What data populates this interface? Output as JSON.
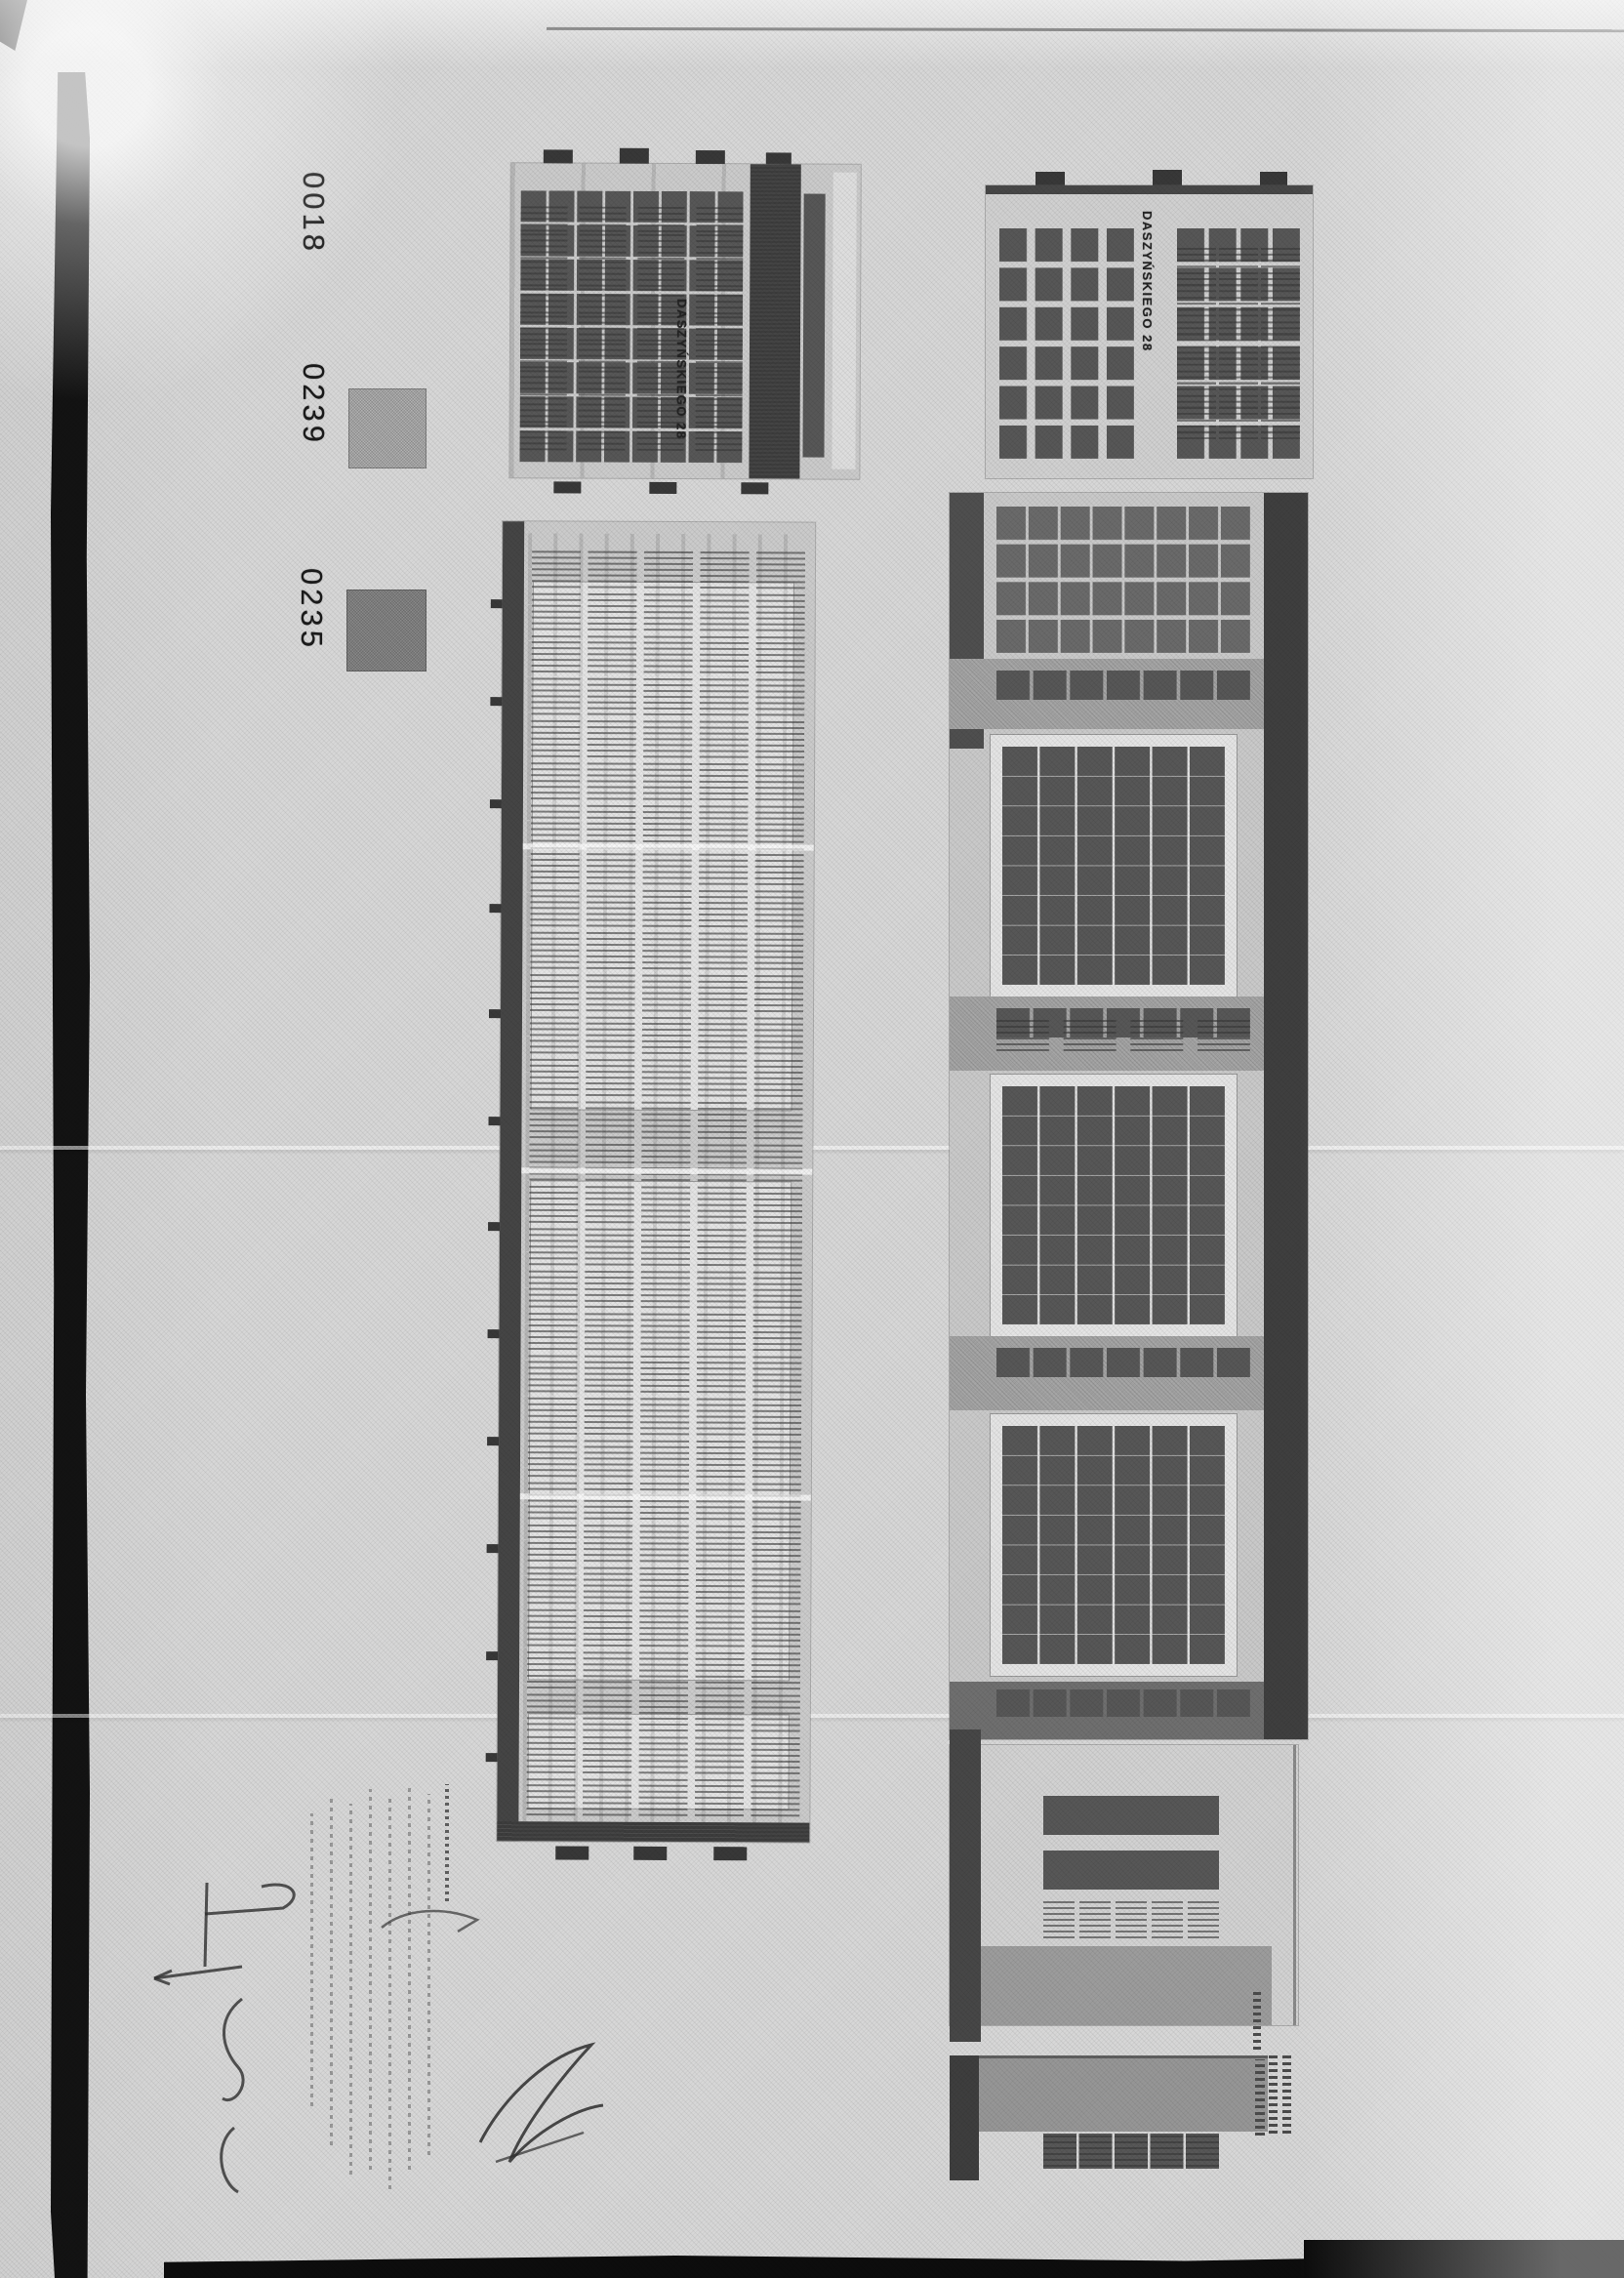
{
  "page": {
    "paper_color": "#d7d7d7",
    "scan_edge_color": "#111111"
  },
  "legend": {
    "items": [
      {
        "code": "0018",
        "swatch_color": null
      },
      {
        "code": "0239",
        "swatch_color": "#b3b3b3"
      },
      {
        "code": "0235",
        "swatch_color": "#8b8b8b"
      }
    ]
  },
  "elevations": {
    "left": {
      "label": "DASZYŃSKIEGO 28"
    },
    "right": {
      "label": "DASZYŃSKIEGO 28"
    }
  },
  "colors": {
    "facade": "#cbcbcb",
    "window": "#575757",
    "dark_band": "#3d3d3d",
    "white_panel": "#e4e4e4",
    "gray_band": "#a6a6a6"
  }
}
